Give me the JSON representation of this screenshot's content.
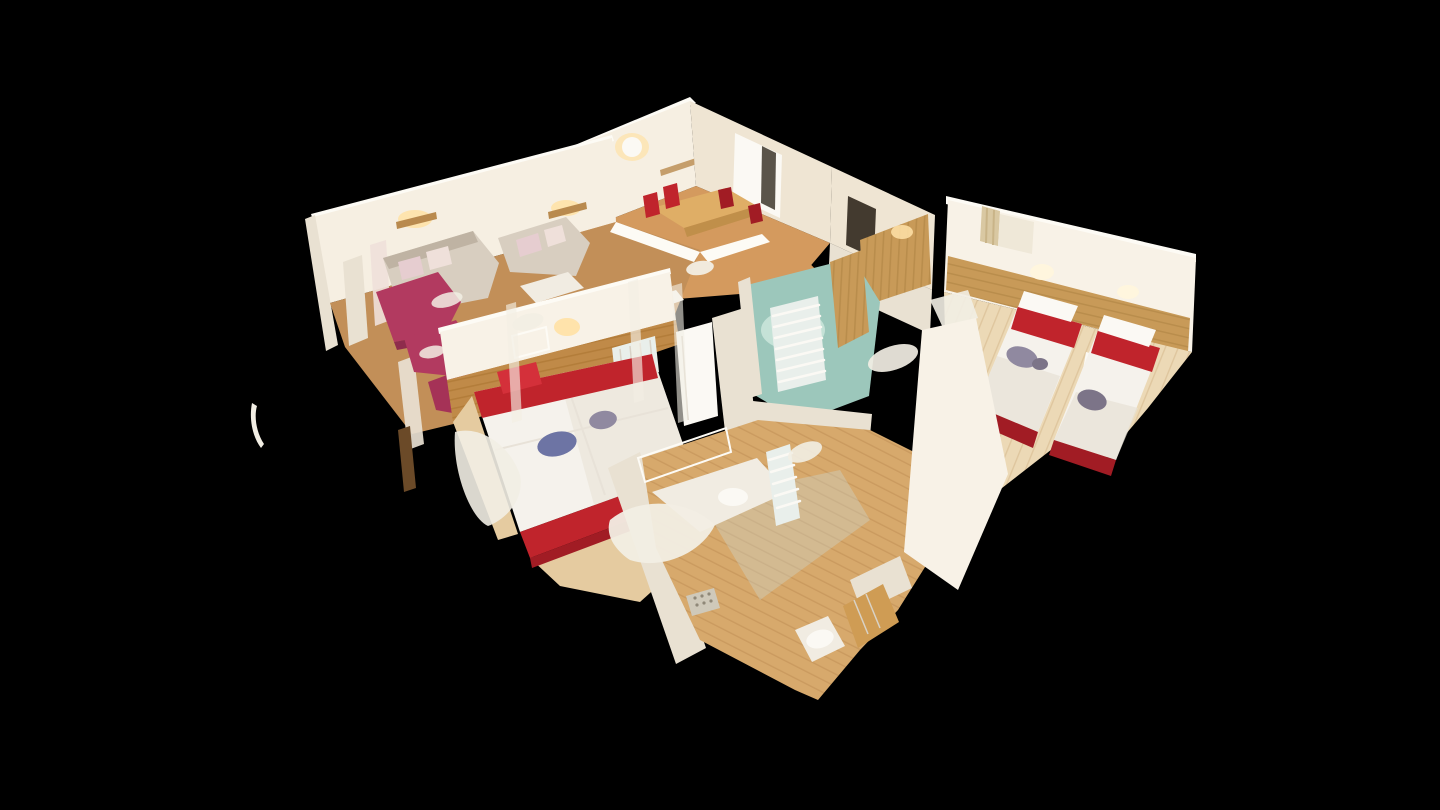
{
  "view": {
    "app": "3d-tour-viewer",
    "mode": "dollhouse-cutaway",
    "description": "Top-down angled 3D dollhouse scan of an apartment with cut-away white walls on a black background"
  },
  "palette": {
    "background": "#000000",
    "wallLit": "#f6efe2",
    "wallBright": "#f8f2e7",
    "wallShade": "#efe5d3",
    "wallDim": "#e9e1d2",
    "wallTop": "#fdfbf5",
    "pine": "#c89a58",
    "pineDark": "#a97f40",
    "pine2": "#c08a48",
    "pine2Dark": "#a8732f",
    "pineDoor": "#cf9c54",
    "pineDoorDark": "#b5823c",
    "woodMid": "#d49a5e",
    "woodTable": "#dfae66",
    "woodTableDark": "#c08f4a",
    "floorLiving": "#c28f58",
    "floorPine": "#ecd9b6",
    "floorPineStripe": "#dcc298",
    "floorPale": "#e5cba0",
    "floorBath": "#d7a96c",
    "floorBathStripe": "#c5945a",
    "teal": "#9cc7bb",
    "tealLight": "#cfe8df",
    "glass": "#b7d6cc",
    "glassLight": "#d4eae2",
    "red": "#c0242c",
    "redBright": "#d4303a",
    "redDark": "#a11c24",
    "magenta": "#b23a60",
    "magentaDark": "#8e2c4c",
    "magentaMid": "#a53257",
    "sofa": "#d8cec0",
    "sofaDark": "#bfb3a3",
    "cushion": "#e6cdd0",
    "cushionLight": "#efe0da",
    "duvet": "#f5f2ec",
    "duvetShade": "#e7e1d6",
    "glow": "#ffe2a8",
    "glowWhite": "#fff6dd",
    "clothesBlue": "#6d74a4",
    "clothesGray": "#9089a0",
    "clothesDark": "#7c7488",
    "mirror": "#ccd9d6",
    "openingDark": "#241c12",
    "whiteSoft": "#fbf9f4",
    "counter": "#f1ece2",
    "windowLight": "#efe8d8",
    "curtain": "#d9c8a2",
    "curtainDark": "#c9b488",
    "shelfWood": "#b98a4e",
    "artifact": "#f2eee4",
    "darkWood": "#6b4a28",
    "drain": "#cfc9ba",
    "drainDot": "#8f8878",
    "seam": "#e8e2d8",
    "finLine": "#d9d2c6",
    "radBase": "#e9efeb"
  },
  "rooms": [
    {
      "id": "dining-room",
      "label": "Dining nook with wooden table and red chairs"
    },
    {
      "id": "living-room",
      "label": "Living room with two beige sofas and magenta armchairs"
    },
    {
      "id": "master-bedroom",
      "label": "Double bedroom, white duvet with red pillows and base"
    },
    {
      "id": "twin-bedroom",
      "label": "Twin bedroom with two red-and-white single beds"
    },
    {
      "id": "small-bathroom",
      "label": "Bathroom with teal floor and towel radiator"
    },
    {
      "id": "main-bathroom",
      "label": "Bathroom with vanity, mirror, shower drain and toilet"
    },
    {
      "id": "hallway",
      "label": "Hallway with doors and wood floor"
    }
  ]
}
